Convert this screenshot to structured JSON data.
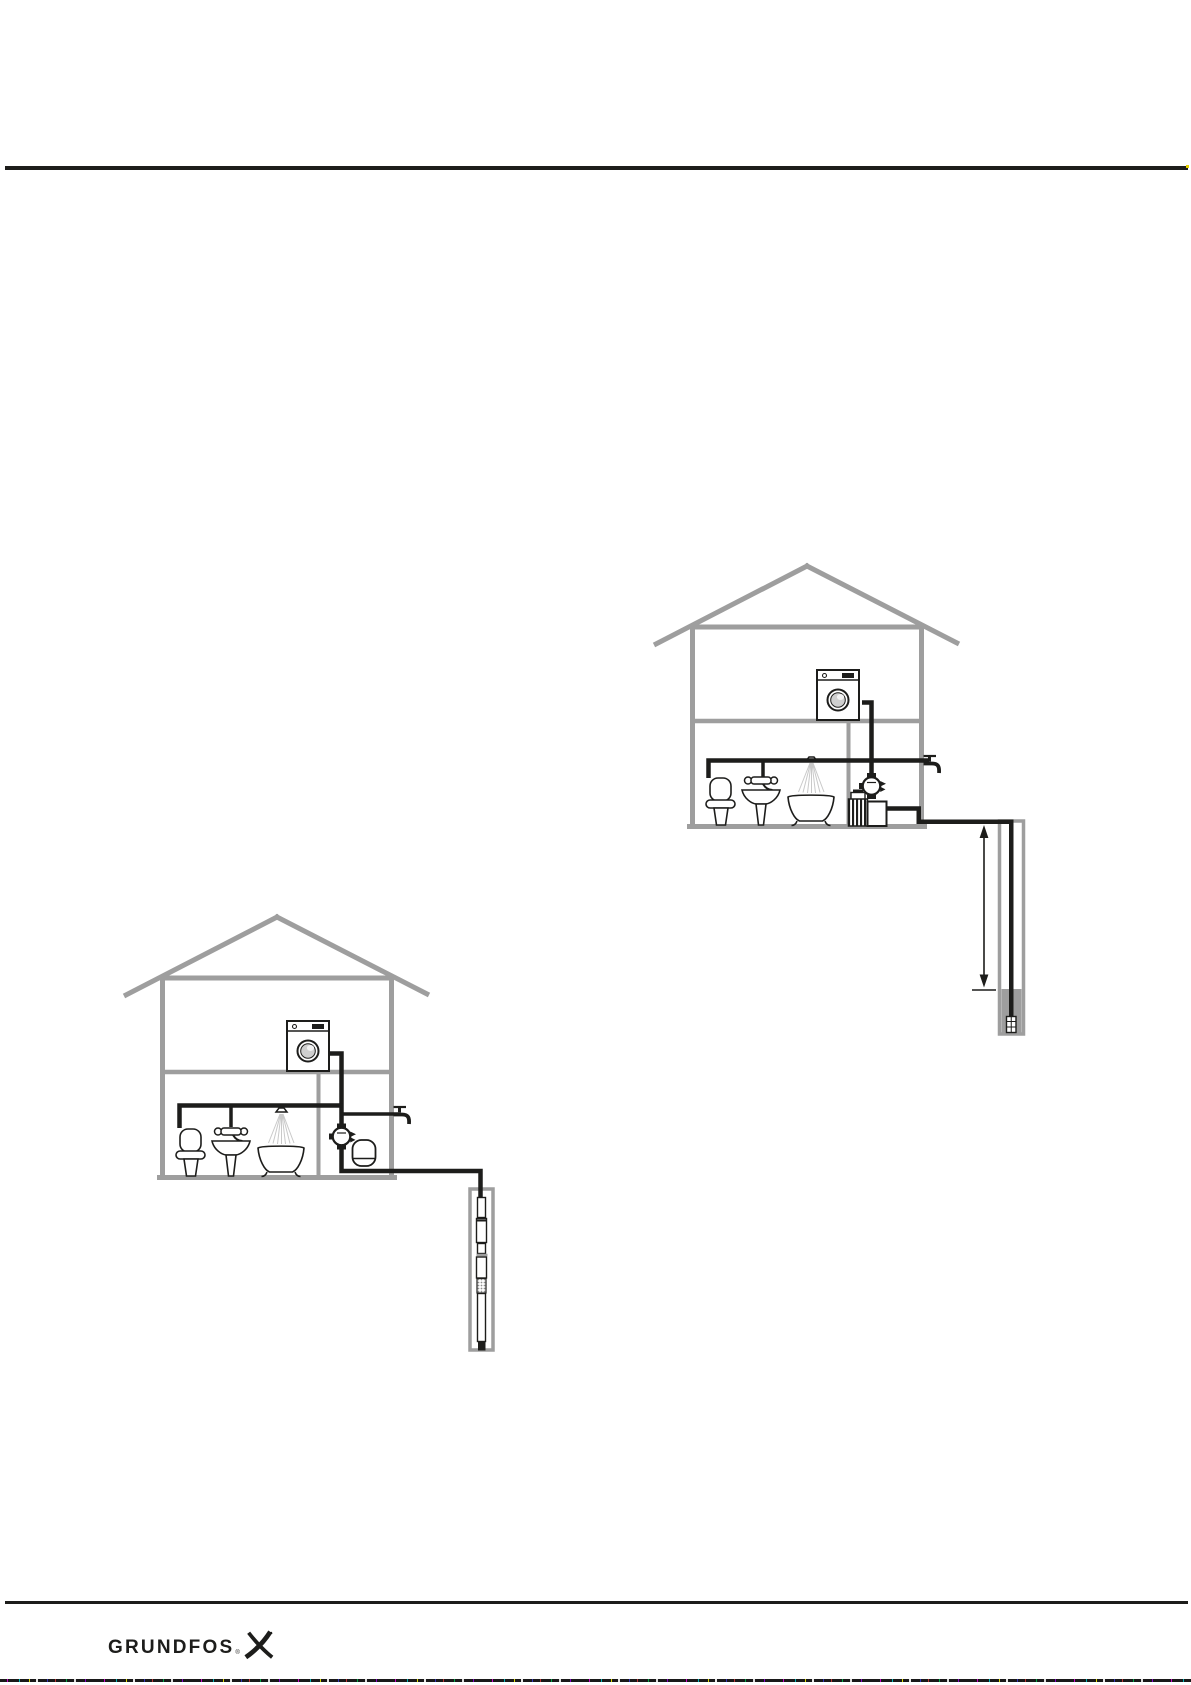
{
  "footer": {
    "logo_text": "GRUNDFOS",
    "registered_mark": "®"
  },
  "colors": {
    "rule_black": "#1d1d1b",
    "pipe_black": "#1d1d1b",
    "structure_gray": "#9e9e9e",
    "water_gray": "#9e9e9e",
    "door_gray": "#cfcfcf",
    "spray_gray": "#c9c9c9",
    "paper_white": "#ffffff",
    "scan_artifact_yellow": "#e6d200"
  },
  "figures": {
    "left": {
      "icon": "submersible-pump-deep-borehole-installation-icon"
    },
    "right": {
      "icon": "jet-pump-shallow-borehole-installation-icon"
    }
  }
}
